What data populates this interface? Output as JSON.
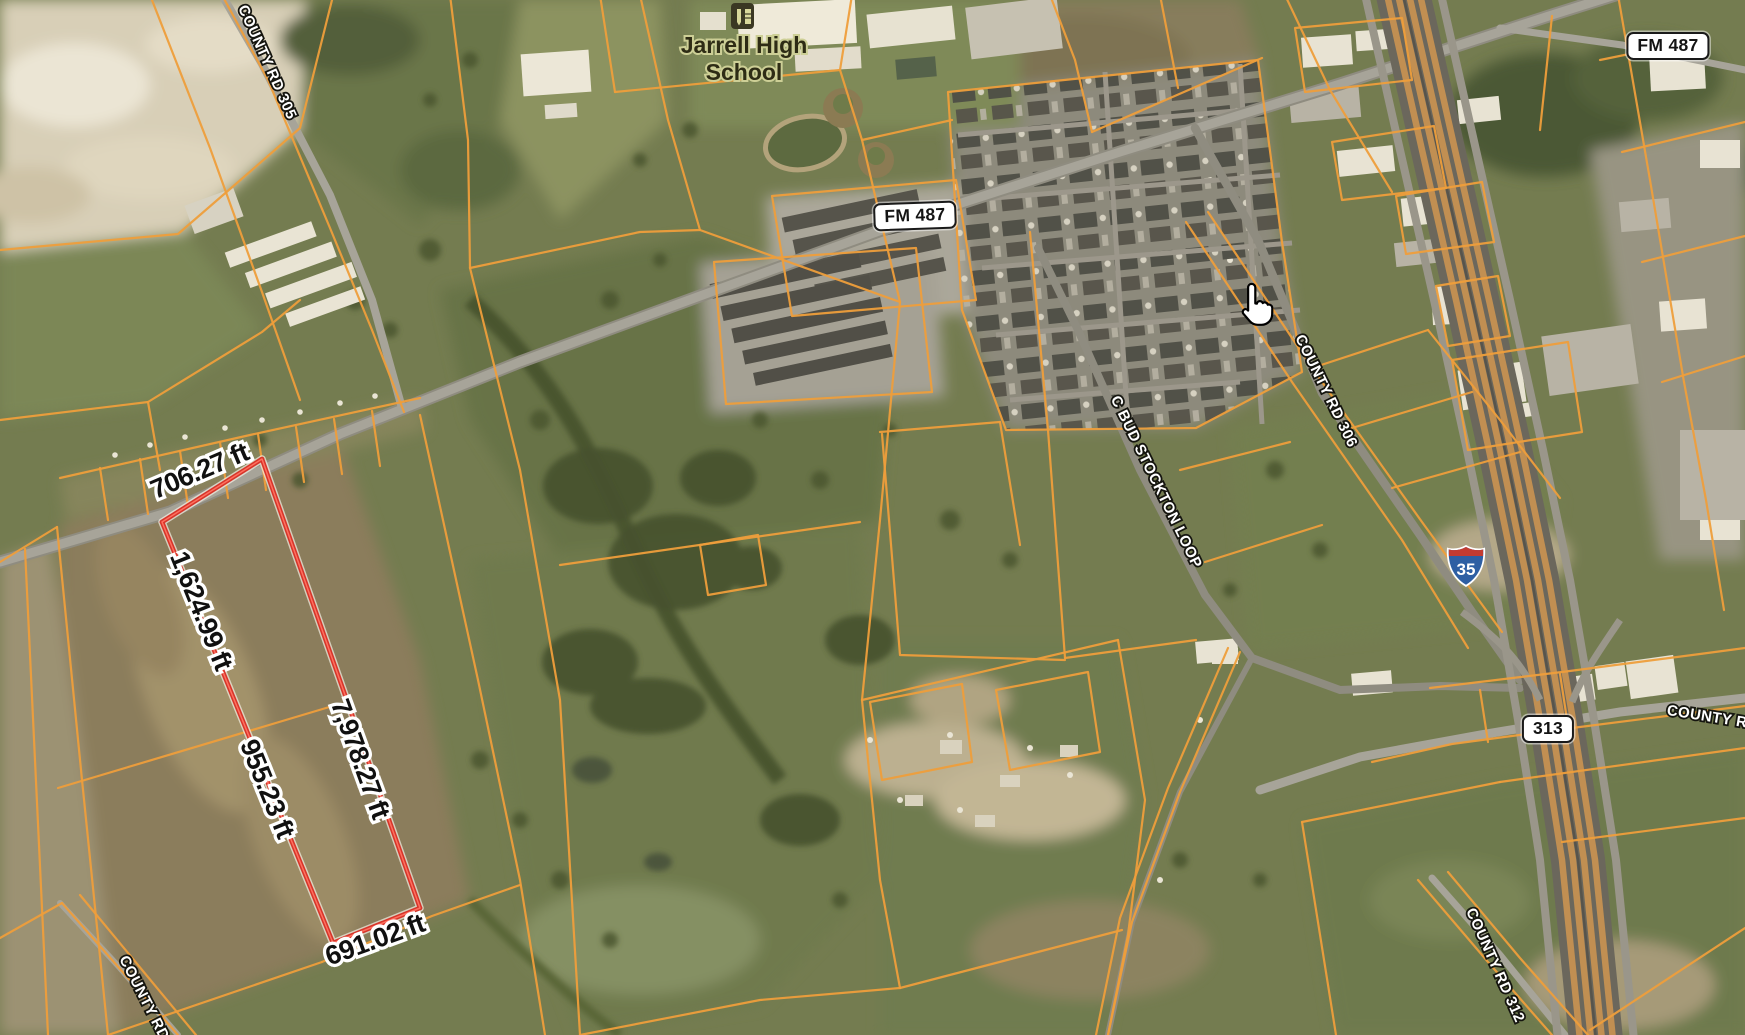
{
  "map": {
    "poi_school": {
      "line1": "Jarrell High",
      "line2": "School"
    },
    "badges": {
      "fm487_main": "FM 487",
      "fm487_ne": "FM 487",
      "sh313": "313"
    },
    "interstate": {
      "i35": "35"
    },
    "roads": {
      "cr305": "COUNTY RD 305",
      "cr306": "COUNTY RD 306",
      "bud": "C BUD STOCKTON LOOP",
      "cr312": "COUNTY RD 312",
      "county_e": "COUNTY RD",
      "county_sw": "COUNTY RD"
    },
    "measure": {
      "top": "706.27 ft",
      "left_upper": "1,624.99 ft",
      "left_lower": "955.23 ft",
      "right": "7,978.27 ft",
      "bottom": "691.02 ft"
    },
    "colors": {
      "parcel_line": "#EE9E3B",
      "measure_line": "#D7352A",
      "badge_bg": "#FFFFFF",
      "badge_border": "#1A1A1A",
      "shield_blue": "#2E5FA3",
      "shield_red": "#C33B31"
    }
  }
}
